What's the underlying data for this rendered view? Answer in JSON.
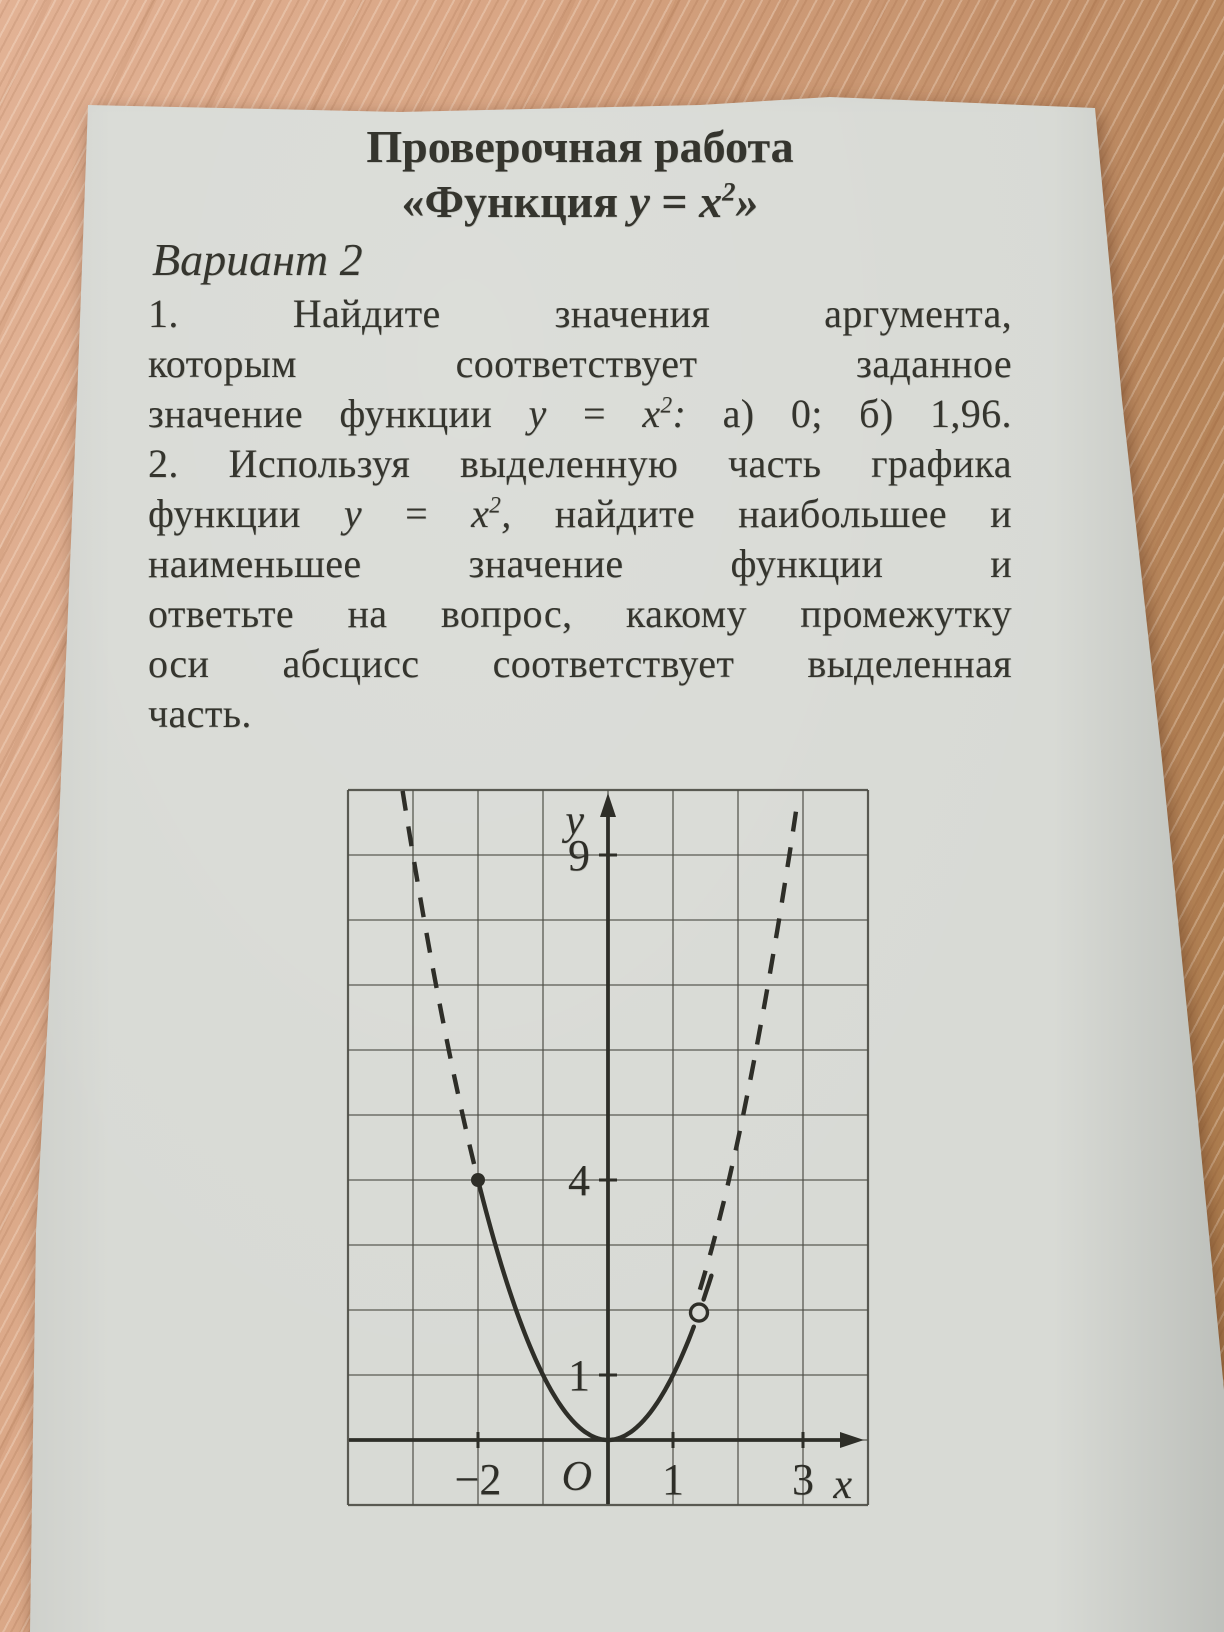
{
  "photo": {
    "desk_wood_light": "#e2b295",
    "desk_wood_dark": "#a87848",
    "paper_color": "#d8dad5",
    "ink_color": "#35352e"
  },
  "document": {
    "title_line1": "Проверочная работа",
    "title_line2_tokens": [
      {
        "t": "«Функция"
      },
      {
        "t": "y",
        "i": 1
      },
      {
        "t": "="
      },
      {
        "t": "x",
        "i": 1,
        "sup": "2",
        "tail": "»"
      }
    ],
    "variant_label": "Вариант 2",
    "body_lines": [
      {
        "justify": true,
        "tokens": [
          {
            "t": "1."
          },
          {
            "t": "Найдите"
          },
          {
            "t": "значения"
          },
          {
            "t": "аргумента,"
          }
        ]
      },
      {
        "justify": true,
        "tokens": [
          {
            "t": "которым"
          },
          {
            "t": "соответствует"
          },
          {
            "t": "заданное"
          }
        ]
      },
      {
        "justify": true,
        "tokens": [
          {
            "t": "значение"
          },
          {
            "t": "функции"
          },
          {
            "t": "y",
            "i": 1
          },
          {
            "t": "="
          },
          {
            "t": "x",
            "i": 1,
            "sup": "2",
            "tail": ":"
          },
          {
            "t": "а)"
          },
          {
            "t": "0;"
          },
          {
            "t": "б)"
          },
          {
            "t": "1,96."
          }
        ]
      },
      {
        "justify": true,
        "tokens": [
          {
            "t": "2."
          },
          {
            "t": "Используя"
          },
          {
            "t": "выделенную"
          },
          {
            "t": "часть"
          },
          {
            "t": "графика"
          }
        ]
      },
      {
        "justify": true,
        "tokens": [
          {
            "t": "функции"
          },
          {
            "t": "y",
            "i": 1
          },
          {
            "t": "="
          },
          {
            "t": "x",
            "i": 1,
            "sup": "2",
            "tail": ","
          },
          {
            "t": "найдите"
          },
          {
            "t": "наибольшее"
          },
          {
            "t": "и"
          }
        ]
      },
      {
        "justify": true,
        "tokens": [
          {
            "t": "наименьшее"
          },
          {
            "t": "значение"
          },
          {
            "t": "функции"
          },
          {
            "t": "и"
          }
        ]
      },
      {
        "justify": true,
        "tokens": [
          {
            "t": "ответьте"
          },
          {
            "t": "на"
          },
          {
            "t": "вопрос,"
          },
          {
            "t": "какому"
          },
          {
            "t": "промежутку"
          }
        ]
      },
      {
        "justify": true,
        "tokens": [
          {
            "t": "оси"
          },
          {
            "t": "абсцисс"
          },
          {
            "t": "соответствует"
          },
          {
            "t": "выделенная"
          }
        ]
      },
      {
        "justify": false,
        "tokens": [
          {
            "t": "часть."
          }
        ]
      }
    ]
  },
  "chart_data": {
    "type": "line",
    "function_id": "x_squared",
    "function_label": "y = x²",
    "x_grid_range": [
      -4,
      4
    ],
    "y_grid_range": [
      -1,
      10
    ],
    "px_per_unit": 65,
    "grid": true,
    "x_axis_label": "x",
    "y_axis_label": "y",
    "origin_label": "O",
    "x_ticks": [
      {
        "v": -2,
        "label": "−2"
      },
      {
        "v": 1,
        "label": "1"
      },
      {
        "v": 3,
        "label": "3"
      }
    ],
    "y_ticks": [
      {
        "v": 9,
        "label": "9"
      },
      {
        "v": 4,
        "label": "4"
      },
      {
        "v": 1,
        "label": "1"
      }
    ],
    "solid_segments": [
      {
        "x_start": -2,
        "x_end": 1.33
      },
      {
        "x_start": 1.47,
        "x_end": 1.6
      }
    ],
    "dashed_segments": [
      {
        "x_start": -3.16,
        "x_end": -2.03,
        "x_scale": 1,
        "name": "parabola-dashed-left"
      },
      {
        "x_start": 1.52,
        "x_end": 3.12,
        "x_scale": 0.93,
        "name": "parabola-dashed-right"
      }
    ],
    "points": [
      {
        "x": -2,
        "y": 4,
        "style": "filled"
      },
      {
        "x": 1.4,
        "y": 1.96,
        "style": "open"
      }
    ],
    "grid_color": "#4c4c44",
    "ink_color": "#2e2e28",
    "paper_color": "#d8dad5"
  }
}
